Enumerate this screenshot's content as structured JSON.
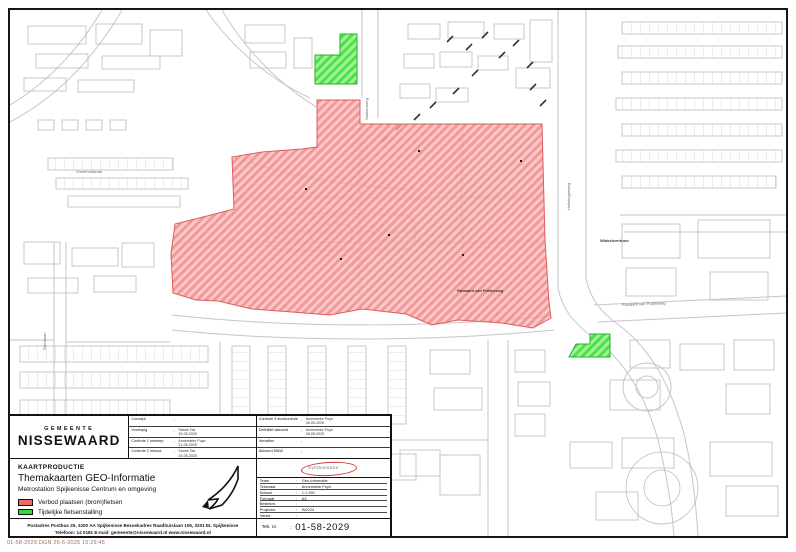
{
  "file_note": "01-58-2029.DGN 26-5-2025 15:29:45",
  "logo": {
    "top": "GEMEENTE",
    "name": "NISSEWAARD"
  },
  "kaartproductie": {
    "heading": "KAARTPRODUCTIE",
    "title": "Themakaarten GEO-Informatie",
    "subtitle": "Metrostation Spijkenisse Centrum en omgeving"
  },
  "legend": {
    "items": [
      {
        "color": "#ee6a6a",
        "label": "Verbod plaatsen (brom)fietsen"
      },
      {
        "color": "#2edb2e",
        "label": "Tijdelijke fietsenstalling"
      }
    ]
  },
  "approvals_left": [
    {
      "label": "Concept",
      "name": "",
      "date": ""
    },
    {
      "label": "Voorlopig",
      "name": "Sanne Tas",
      "date": "19-05-2025"
    },
    {
      "label": "Controle 1 ontwerp",
      "name": "Annemieke Puyn",
      "date": "21-05-2025"
    },
    {
      "label": "Controle 2 inhoud",
      "name": "Sanne Tas",
      "date": "23-05-2025"
    }
  ],
  "approvals_right": [
    {
      "label": "Controle 3 eindcontrole",
      "name": "Annemieke Puyn",
      "date": "26-05-2025"
    },
    {
      "label": "Definitief akkoord",
      "name": "Annemieke Puyn",
      "date": "26-05-2025"
    },
    {
      "label": "Vervallen",
      "name": "",
      "date": ""
    },
    {
      "label": "Akkoord M&W",
      "name": "",
      "date": ""
    }
  ],
  "stamp_text": "Symbolisatie",
  "details": [
    {
      "label": "Team",
      "value": "Geo-Informatie"
    },
    {
      "label": "Tekenaar",
      "value": "Annemieke Puyn"
    },
    {
      "label": "Schaal",
      "value": "1:1.250"
    },
    {
      "label": "Formaat",
      "value": "A3"
    },
    {
      "label": "Besteknr.",
      "value": ""
    },
    {
      "label": "Projectnr.",
      "value": "W2024"
    },
    {
      "label": "Versie",
      "value": ""
    }
  ],
  "teknr": {
    "label": "Tek. nr.",
    "value": "01-58-2029"
  },
  "address": {
    "line1": "Postadres Postbus 25, 3200 AA Spijkenisse   Bezoekadres Raadhuislaan 106, 3201 EL Spijkenisse",
    "line2": "Telefoon: 14 0181   E-mail: gemeente@nissewaard.nl   www.nissewaard.nl"
  },
  "map": {
    "zone_colors": {
      "restricted": "#ee6a6a",
      "temporary": "#2edb2e"
    },
    "labels": [
      {
        "text": "Ruwaard van Puttenweg",
        "x": 447,
        "y": 282,
        "rotate": 0,
        "emphasis": true
      },
      {
        "text": "Ruwaard van Puttenweg",
        "x": 612,
        "y": 296,
        "rotate": -2,
        "emphasis": false
      },
      {
        "text": "Hekelingseweg",
        "x": 560,
        "y": 200,
        "rotate": -90,
        "emphasis": false
      },
      {
        "text": "Stationsweg",
        "x": 358,
        "y": 110,
        "rotate": -90,
        "emphasis": false
      },
      {
        "text": "Vredehofstraat",
        "x": 66,
        "y": 163,
        "rotate": 0,
        "emphasis": false
      },
      {
        "text": "Eikenlaan",
        "x": 36,
        "y": 340,
        "rotate": -90,
        "emphasis": false
      },
      {
        "text": "Winkelcentrum",
        "x": 590,
        "y": 232,
        "rotate": 0,
        "emphasis": true
      }
    ]
  }
}
